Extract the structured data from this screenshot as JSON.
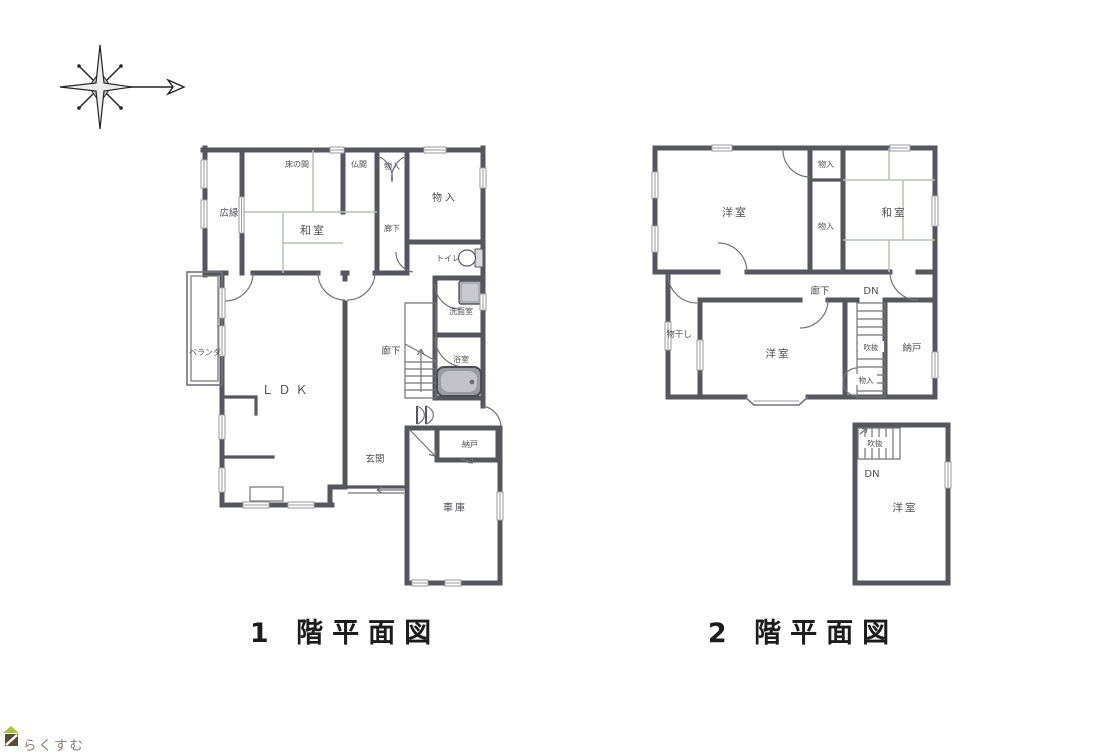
{
  "page": {
    "background": "#ffffff"
  },
  "colors": {
    "wall": "#56565e",
    "line": "#73737b",
    "tatami": "#b7c3ae",
    "label": "#4e4e56",
    "fixture": "#9a9aa0",
    "title": "#1c1c1c",
    "logo-text": "#8d7c70",
    "logo-roof": "#a9c23f",
    "logo-body": "#5d4a39"
  },
  "compass": {
    "description": "eight-point compass rose with north arrow pointing right"
  },
  "floor1": {
    "title": "1 階平面図",
    "rooms": {
      "hiroen": "広縁",
      "tokonoma": "床の間",
      "butsuma": "仏間",
      "monoire_top": "物入",
      "monoire_large": "物入",
      "washitsu": "和室",
      "rouka_upper": "廊下",
      "toire": "トイレ",
      "senmenshitsu": "洗面室",
      "rouka": "廊下",
      "yokushitsu": "浴室",
      "veranda": "ベランダ",
      "ldk": "ＬＤＫ",
      "genkan": "玄関",
      "nando": "納戸",
      "shako": "車庫"
    }
  },
  "floor2": {
    "title": "2 階平面図",
    "rooms": {
      "yoshitsu_nw": "洋室",
      "monoire_top": "物入",
      "monoire_mid": "物入",
      "washitsu": "和室",
      "rouka": "廊下",
      "dn_upper": "DN",
      "monohoshi": "物干し",
      "yoshitsu_center": "洋室",
      "fukinuke_mid": "吹抜",
      "nando": "納戸",
      "monoire_stairs": "物入",
      "fukinuke_lower": "吹抜",
      "dn_lower": "DN",
      "yoshitsu_south": "洋室"
    }
  },
  "logo": {
    "text": "らくすむ"
  }
}
